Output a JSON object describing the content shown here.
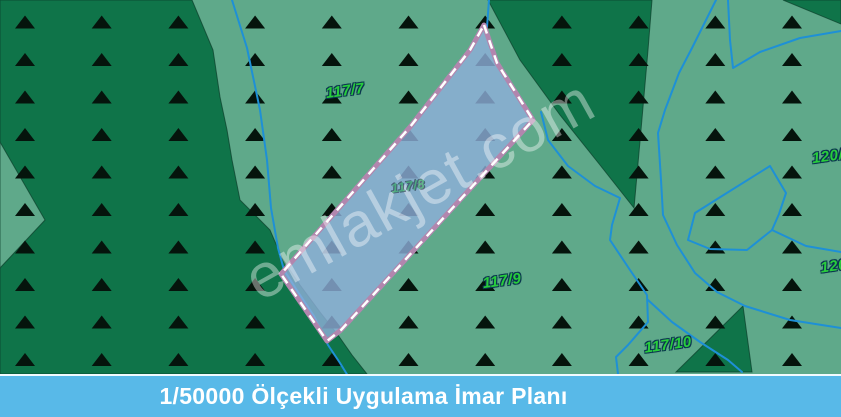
{
  "map": {
    "colors": {
      "background_light_green": "#5fa98a",
      "forest_dark_green": "#0f7449",
      "region_outline": "#0a3d2a",
      "symbol_black": "#05140c",
      "stream_blue": "#1e90d6",
      "parcel_fill": "rgba(143,175,219,0.80)",
      "parcel_border_mauve": "#b286ae",
      "parcel_dash_white": "#ffffff"
    },
    "regions": [
      {
        "name": "forest-region-left",
        "tone": "dark",
        "points": [
          [
            0,
            0
          ],
          [
            192,
            0
          ],
          [
            213,
            50
          ],
          [
            220,
            97
          ],
          [
            227,
            130
          ],
          [
            232,
            160
          ],
          [
            240,
            200
          ],
          [
            256,
            216
          ],
          [
            270,
            230
          ],
          [
            282,
            258
          ],
          [
            300,
            285
          ],
          [
            320,
            312
          ],
          [
            338,
            335
          ],
          [
            352,
            355
          ],
          [
            367,
            374
          ],
          [
            0,
            374
          ]
        ]
      },
      {
        "name": "clearing-notch-left",
        "tone": "light",
        "points": [
          [
            0,
            142
          ],
          [
            45,
            220
          ],
          [
            0,
            268
          ]
        ]
      },
      {
        "name": "forest-wedge-top-center",
        "tone": "dark",
        "points": [
          [
            488,
            0
          ],
          [
            652,
            0
          ],
          [
            648,
            50
          ],
          [
            641,
            130
          ],
          [
            634,
            208
          ],
          [
            600,
            165
          ],
          [
            560,
            115
          ],
          [
            520,
            60
          ]
        ]
      },
      {
        "name": "forest-corner-top-right",
        "tone": "dark",
        "points": [
          [
            783,
            0
          ],
          [
            841,
            0
          ],
          [
            841,
            24
          ]
        ]
      },
      {
        "name": "forest-triangle-bottom-right",
        "tone": "dark",
        "points": [
          [
            743,
            306
          ],
          [
            676,
            372
          ],
          [
            752,
            372
          ]
        ]
      }
    ],
    "symbol_grid": {
      "symbol": "forest-triangle",
      "x0": 25,
      "y0": 22,
      "dx": 76.7,
      "dy": 37.5,
      "cols": 11,
      "rows": 10,
      "half_width": 10,
      "half_height": 6.5
    },
    "streams": [
      [
        [
          232,
          0
        ],
        [
          247,
          48
        ],
        [
          260,
          110
        ],
        [
          267,
          160
        ],
        [
          271,
          208
        ],
        [
          278,
          248
        ],
        [
          284,
          270
        ],
        [
          298,
          292
        ],
        [
          314,
          316
        ],
        [
          328,
          345
        ],
        [
          340,
          363
        ],
        [
          348,
          376
        ]
      ],
      [
        [
          489,
          0
        ],
        [
          487,
          27
        ]
      ],
      [
        [
          716,
          0
        ],
        [
          692,
          48
        ],
        [
          679,
          73
        ],
        [
          665,
          110
        ],
        [
          658,
          133
        ],
        [
          661,
          180
        ],
        [
          663,
          215
        ],
        [
          677,
          245
        ],
        [
          695,
          273
        ],
        [
          717,
          292
        ],
        [
          745,
          306
        ],
        [
          790,
          320
        ],
        [
          841,
          328
        ]
      ],
      [
        [
          728,
          0
        ],
        [
          730,
          40
        ],
        [
          733,
          68
        ],
        [
          760,
          52
        ],
        [
          800,
          38
        ],
        [
          841,
          31
        ]
      ],
      [
        [
          770,
          166
        ],
        [
          722,
          196
        ],
        [
          695,
          213
        ],
        [
          688,
          240
        ],
        [
          710,
          249
        ],
        [
          747,
          250
        ],
        [
          772,
          230
        ],
        [
          779,
          214
        ],
        [
          786,
          193
        ],
        [
          770,
          166
        ]
      ],
      [
        [
          772,
          230
        ],
        [
          806,
          246
        ],
        [
          841,
          252
        ]
      ],
      [
        [
          541,
          112
        ],
        [
          548,
          140
        ],
        [
          568,
          166
        ],
        [
          595,
          186
        ],
        [
          620,
          198
        ],
        [
          612,
          225
        ],
        [
          610,
          240
        ],
        [
          630,
          270
        ],
        [
          647,
          295
        ],
        [
          648,
          322
        ],
        [
          628,
          345
        ],
        [
          616,
          357
        ],
        [
          618,
          374
        ]
      ],
      [
        [
          648,
          300
        ],
        [
          672,
          322
        ],
        [
          700,
          342
        ],
        [
          728,
          360
        ],
        [
          742,
          372
        ]
      ]
    ],
    "parcel": {
      "points": [
        [
          484,
          25
        ],
        [
          497,
          63
        ],
        [
          533,
          120
        ],
        [
          341,
          330
        ],
        [
          327,
          341
        ],
        [
          281,
          274
        ],
        [
          410,
          127
        ],
        [
          470,
          50
        ]
      ],
      "label": "117/8"
    },
    "labels": [
      {
        "text": "117/7",
        "x": 345,
        "y": 91,
        "dim": false
      },
      {
        "text": "117/9",
        "x": 502,
        "y": 281,
        "dim": false
      },
      {
        "text": "117/10",
        "x": 668,
        "y": 345,
        "dim": false
      },
      {
        "text": "120/8",
        "x": 832,
        "y": 156,
        "dim": false
      },
      {
        "text": "120/",
        "x": 836,
        "y": 266,
        "dim": false
      },
      {
        "text": "117/8",
        "x": 408,
        "y": 186,
        "dim": true
      }
    ]
  },
  "watermark": {
    "text": "emlakjet.com"
  },
  "footer": {
    "title": "1/50000 Ölçekli Uygulama İmar Planı"
  }
}
